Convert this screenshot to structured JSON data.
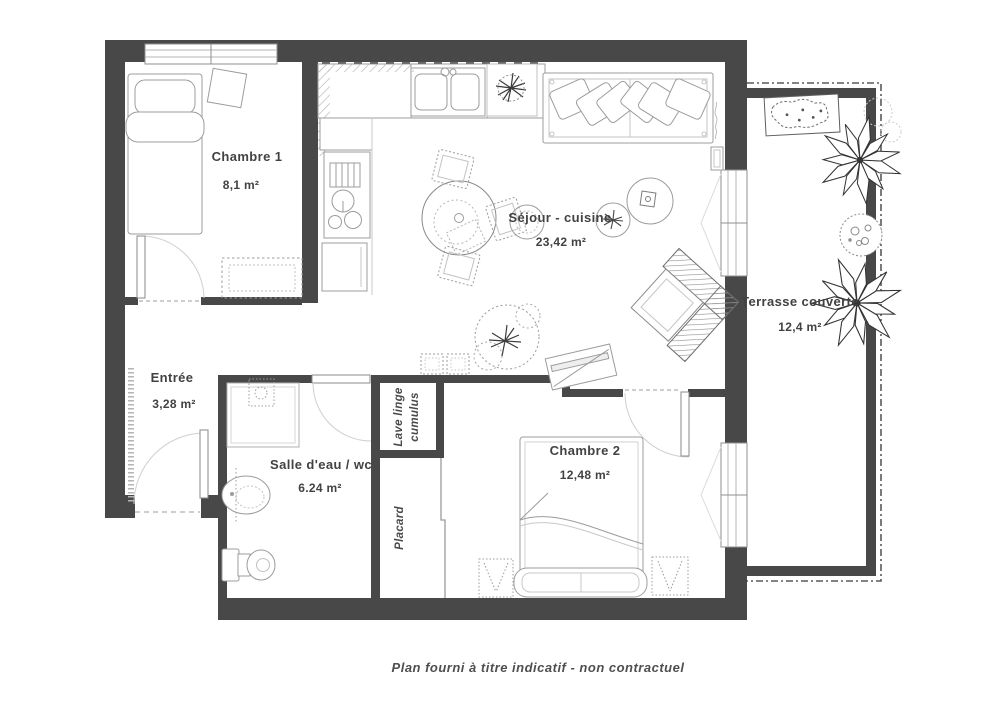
{
  "rooms": {
    "chambre1": {
      "name": "Chambre 1",
      "area": "8,1 m²"
    },
    "sejour_cuisine": {
      "name": "Séjour - cuisine",
      "area": "23,42 m²"
    },
    "terrasse": {
      "name": "Terrasse couverte",
      "area": "12,4 m²"
    },
    "entree": {
      "name": "Entrée",
      "area": "3,28 m²"
    },
    "salle_eau": {
      "name": "Salle d'eau / wc",
      "area": "6.24 m²"
    },
    "chambre2": {
      "name": "Chambre 2",
      "area": "12,48 m²"
    }
  },
  "storage": {
    "lave_linge": {
      "line1": "Lave linge",
      "line2": "cumulus"
    },
    "placard": "Placard"
  },
  "caption": "Plan fourni à titre indicatif - non contractuel",
  "colors": {
    "wall": "#484848",
    "furniture_line": "#9c9c9c",
    "text": "#424242",
    "background": "#ffffff"
  }
}
